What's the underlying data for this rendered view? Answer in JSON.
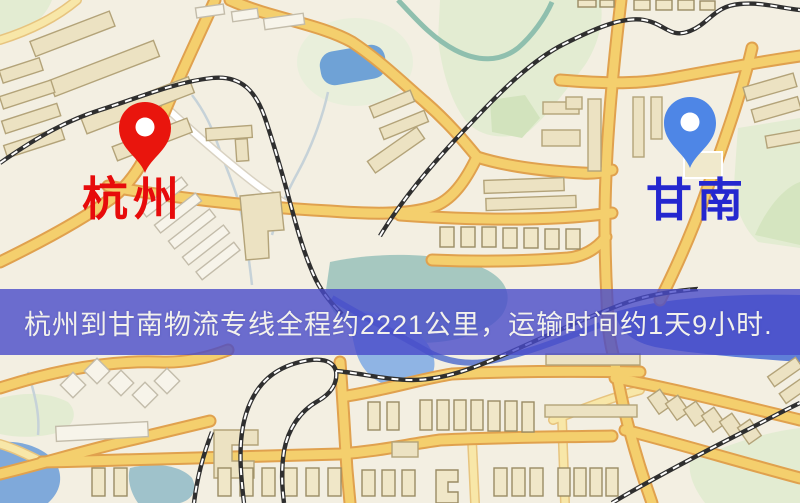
{
  "map": {
    "origin": {
      "name": "杭州",
      "pin_color": "#e9150d",
      "label_color": "#e70b0b"
    },
    "destination": {
      "name": "甘南",
      "pin_color": "#4e86e6",
      "label_color": "#2427cf"
    },
    "banner": {
      "text": "杭州到甘南物流专线全程约2221公里，运输时间约1天9小时.",
      "route": "杭州到甘南物流专线",
      "distance_km": "2221",
      "duration": "1天9小时",
      "background_color": "#4b4bc9",
      "text_color": "#f2f1ec"
    },
    "palette": {
      "background": "#f3efe2",
      "road_fill": "#f4cf6d",
      "road_casing": "#e0a14e",
      "park_green": "#e3ecd2",
      "water_blue": "#6fa2d6",
      "railway_dark": "#2f2f2f",
      "building_beige": "#ece2c2"
    }
  }
}
